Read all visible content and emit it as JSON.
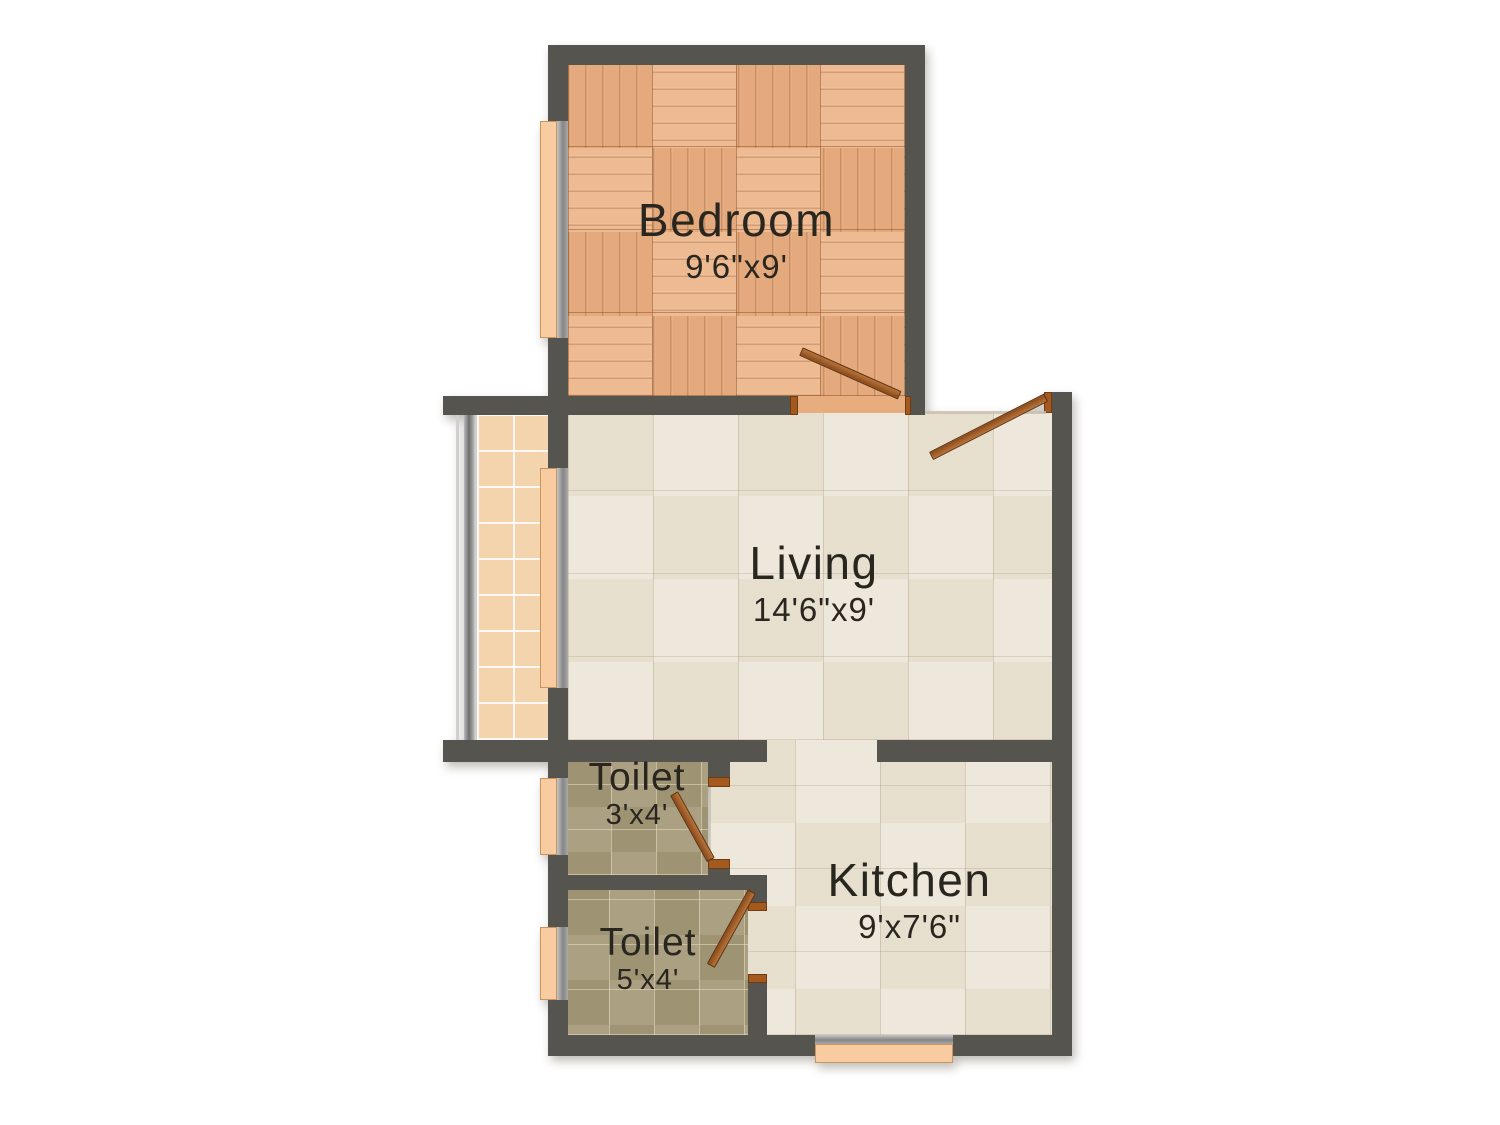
{
  "plan_type": "floor-plan",
  "rooms": {
    "bedroom": {
      "name": "Bedroom",
      "dims": "9'6\"x9'"
    },
    "living": {
      "name": "Living",
      "dims": "14'6\"x9'"
    },
    "toilet_small": {
      "name": "Toilet",
      "dims": "3'x4'"
    },
    "toilet_large": {
      "name": "Toilet",
      "dims": "5'x4'"
    },
    "kitchen": {
      "name": "Kitchen",
      "dims": "9'x7'6\""
    }
  },
  "colors": {
    "wall": "#56544e",
    "bedroom_wood_floor": "#ecb286",
    "living_kitchen_tile": "#ebe4d5",
    "toilet_tile": "#a69b7b",
    "balcony_tile": "#f3d4ad",
    "window_sill": "#f8cba1",
    "window_frame_gray": "#8f8f8f",
    "door_leaf": "#9a5a26",
    "label_text": "#29261f",
    "background": "#ffffff"
  }
}
